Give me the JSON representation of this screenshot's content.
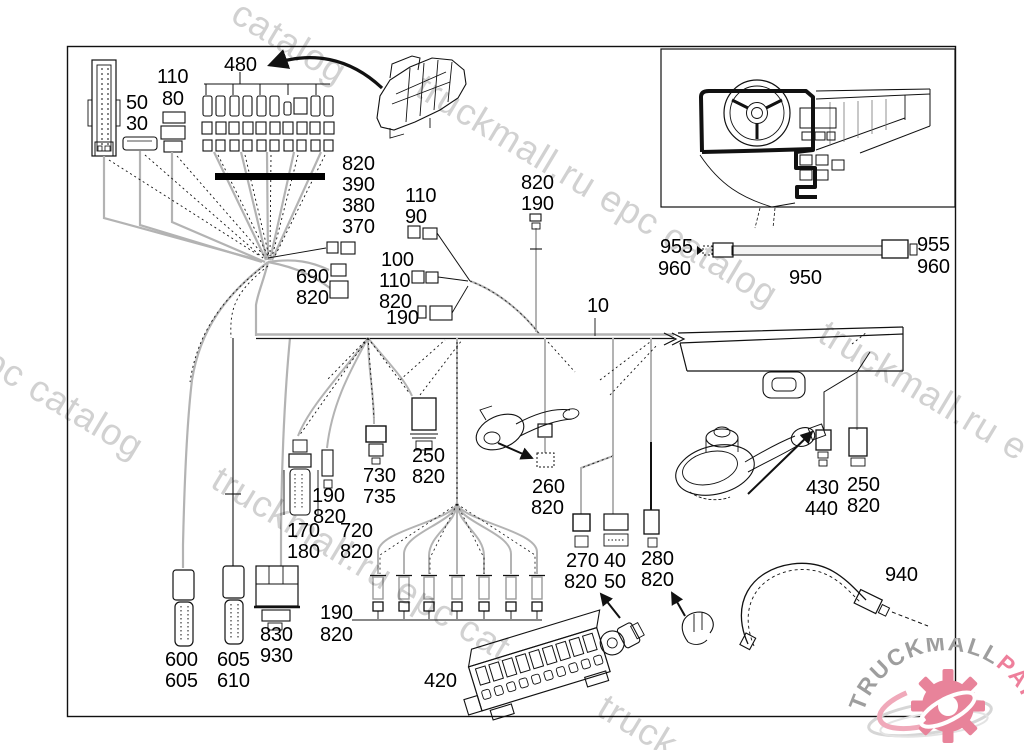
{
  "diagram": {
    "description": "cab wiring harness parts diagram",
    "part_labels": [
      {
        "t": "50",
        "x": 126,
        "y": 93
      },
      {
        "t": "30",
        "x": 126,
        "y": 114
      },
      {
        "t": "110",
        "x": 157,
        "y": 67
      },
      {
        "t": "80",
        "x": 162,
        "y": 89
      },
      {
        "t": "480",
        "x": 224,
        "y": 55
      },
      {
        "t": "820",
        "x": 342,
        "y": 154
      },
      {
        "t": "390",
        "x": 342,
        "y": 175
      },
      {
        "t": "380",
        "x": 342,
        "y": 196
      },
      {
        "t": "370",
        "x": 342,
        "y": 217
      },
      {
        "t": "110",
        "x": 405,
        "y": 186
      },
      {
        "t": "90",
        "x": 405,
        "y": 207
      },
      {
        "t": "820",
        "x": 521,
        "y": 173
      },
      {
        "t": "190",
        "x": 521,
        "y": 194
      },
      {
        "t": "100",
        "x": 381,
        "y": 250
      },
      {
        "t": "110",
        "x": 379,
        "y": 271
      },
      {
        "t": "820",
        "x": 379,
        "y": 292
      },
      {
        "t": "190",
        "x": 386,
        "y": 308
      },
      {
        "t": "690",
        "x": 296,
        "y": 267
      },
      {
        "t": "820",
        "x": 296,
        "y": 288
      },
      {
        "t": "10",
        "x": 587,
        "y": 296
      },
      {
        "t": "955",
        "x": 660,
        "y": 237
      },
      {
        "t": "960",
        "x": 658,
        "y": 259
      },
      {
        "t": "950",
        "x": 789,
        "y": 268
      },
      {
        "t": "955",
        "x": 917,
        "y": 235
      },
      {
        "t": "960",
        "x": 917,
        "y": 257
      },
      {
        "t": "250",
        "x": 412,
        "y": 446
      },
      {
        "t": "820",
        "x": 412,
        "y": 467
      },
      {
        "t": "730",
        "x": 363,
        "y": 466
      },
      {
        "t": "735",
        "x": 363,
        "y": 487
      },
      {
        "t": "190",
        "x": 312,
        "y": 486
      },
      {
        "t": "820",
        "x": 313,
        "y": 507
      },
      {
        "t": "170",
        "x": 287,
        "y": 521
      },
      {
        "t": "180",
        "x": 287,
        "y": 542
      },
      {
        "t": "720",
        "x": 340,
        "y": 521
      },
      {
        "t": "820",
        "x": 340,
        "y": 542
      },
      {
        "t": "260",
        "x": 532,
        "y": 477
      },
      {
        "t": "820",
        "x": 531,
        "y": 498
      },
      {
        "t": "270",
        "x": 566,
        "y": 551
      },
      {
        "t": "820",
        "x": 564,
        "y": 572
      },
      {
        "t": "40",
        "x": 604,
        "y": 551
      },
      {
        "t": "50",
        "x": 604,
        "y": 572
      },
      {
        "t": "280",
        "x": 641,
        "y": 549
      },
      {
        "t": "820",
        "x": 641,
        "y": 570
      },
      {
        "t": "430",
        "x": 806,
        "y": 478
      },
      {
        "t": "440",
        "x": 805,
        "y": 499
      },
      {
        "t": "250",
        "x": 847,
        "y": 475
      },
      {
        "t": "820",
        "x": 847,
        "y": 496
      },
      {
        "t": "940",
        "x": 885,
        "y": 565
      },
      {
        "t": "600",
        "x": 165,
        "y": 650
      },
      {
        "t": "605",
        "x": 165,
        "y": 671
      },
      {
        "t": "605",
        "x": 217,
        "y": 650
      },
      {
        "t": "610",
        "x": 217,
        "y": 671
      },
      {
        "t": "830",
        "x": 260,
        "y": 625
      },
      {
        "t": "930",
        "x": 260,
        "y": 646
      },
      {
        "t": "190",
        "x": 320,
        "y": 603
      },
      {
        "t": "820",
        "x": 320,
        "y": 625
      },
      {
        "t": "420",
        "x": 424,
        "y": 671
      }
    ]
  },
  "watermarks": [
    {
      "t": "catalog",
      "x": 246,
      "y": -8
    },
    {
      "t": "truckmall.ru epc catalog",
      "x": 430,
      "y": 66
    },
    {
      "t": "l epc catalog",
      "x": -38,
      "y": 318
    },
    {
      "t": "truckmall.ru e",
      "x": 833,
      "y": 312
    },
    {
      "t": "truckmall.ru epc cat",
      "x": 226,
      "y": 458
    },
    {
      "t": "truck",
      "x": 612,
      "y": 686
    }
  ],
  "logo": {
    "text_gray": "TRUCKMALL",
    "text_pink": "PARTS"
  },
  "colors": {
    "line": "#111111",
    "wire_gray": "#b3b3b3",
    "watermark": "#c9c9c9",
    "logo_gray": "#9e9e9e",
    "logo_pink": "#ee7f9b"
  }
}
